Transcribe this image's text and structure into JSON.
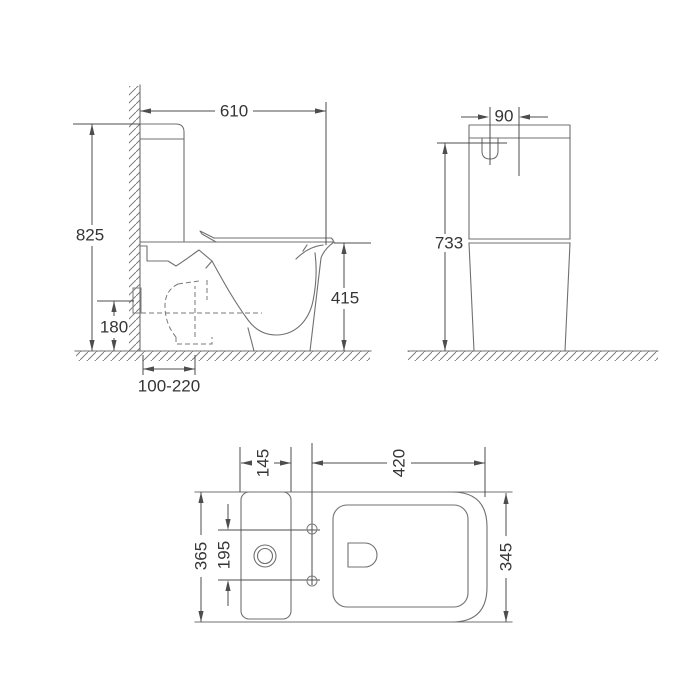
{
  "views": {
    "side": {
      "width": "610",
      "overall_height": "825",
      "seat_height": "415",
      "outlet_height": "180",
      "outlet_setout_range": "100-220"
    },
    "rear": {
      "inlet_offset": "90",
      "inlet_height": "733"
    },
    "top": {
      "tank_depth": "145",
      "bowl_length": "420",
      "overall_width": "365",
      "fixing_hole_spacing": "195",
      "bowl_width": "345"
    }
  },
  "colors": {
    "background": "#ffffff",
    "outline": "#707070",
    "dimension": "#4d4d4d",
    "text": "#353537"
  }
}
